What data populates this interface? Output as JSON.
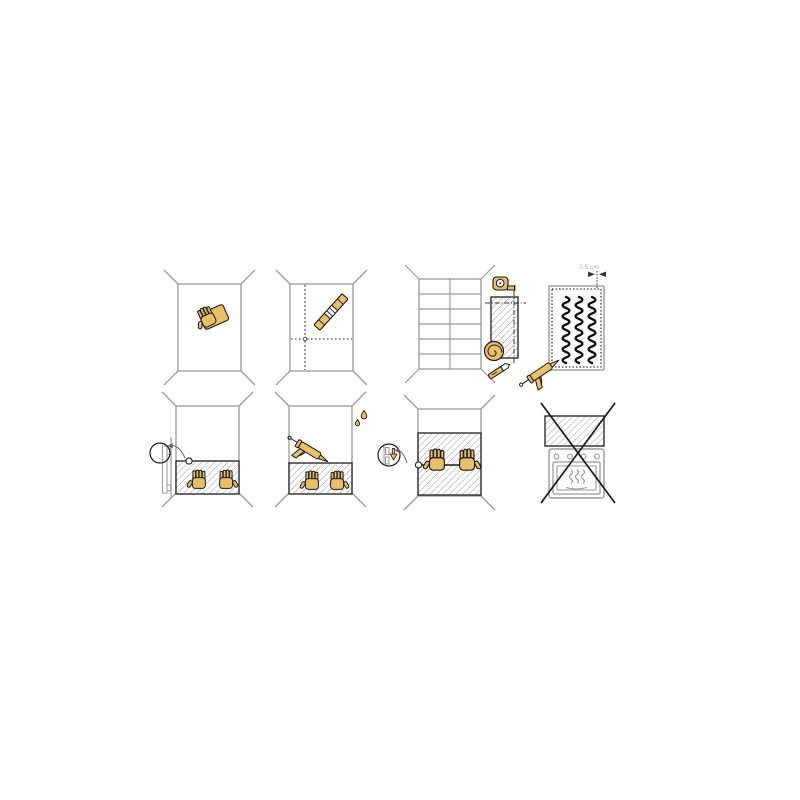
{
  "sheet": {
    "type": "wall-panel-installation-instructions",
    "grid": {
      "rows": 2,
      "columns": 4
    }
  },
  "labels": {
    "gap_measurement": "0,5 cm"
  },
  "colors": {
    "background": "#ffffff",
    "tool_tan": "#e8c06a",
    "outline_dark": "#1a1a1a",
    "structure_gray": "#999999",
    "hatch_gray": "#9b9b9b",
    "panel_border_dark": "#2e2e2e",
    "adhesive_black": "#111111",
    "label_gray": "#b0b0b0"
  },
  "steps": [
    {
      "index": 1,
      "name": "clean-wall",
      "icons": [
        "wall",
        "hand-sponge-icon"
      ]
    },
    {
      "index": 2,
      "name": "mark-guide-lines",
      "icons": [
        "wall",
        "dotted-guide-lines",
        "spirit-level-icon"
      ]
    },
    {
      "index": 3,
      "name": "measure-and-cut-panel",
      "icons": [
        "tiled-wall",
        "tape-measure-icon",
        "panel-piece",
        "coil-icon",
        "utility-knife-icon"
      ]
    },
    {
      "index": 4,
      "name": "apply-adhesive-to-panel-back",
      "gap_label": "0,5 cm",
      "icons": [
        "panel-back",
        "dotted-margin",
        "adhesive-beads",
        "caulking-gun-icon",
        "gap-dimension-arrows"
      ]
    },
    {
      "index": 5,
      "name": "press-panel-to-wall",
      "icons": [
        "wall",
        "mounted-panel",
        "pressing-hands",
        "side-profile-detail",
        "magnifier-circle",
        "detail-arrow"
      ]
    },
    {
      "index": 6,
      "name": "seal-top-edge",
      "icons": [
        "wall",
        "mounted-panel",
        "pressing-hands",
        "caulking-gun-icon",
        "water-drops"
      ]
    },
    {
      "index": 7,
      "name": "join-second-panel",
      "icons": [
        "wall",
        "two-mounted-panels",
        "joint-line",
        "pressing-hands",
        "joint-profile-detail",
        "magnifier-circle",
        "down-arrow",
        "detail-arrow"
      ]
    },
    {
      "index": 8,
      "name": "do-not-install-above-stove",
      "prohibition": true,
      "icons": [
        "mounted-panel",
        "oven-icon",
        "prohibition-cross"
      ]
    }
  ]
}
